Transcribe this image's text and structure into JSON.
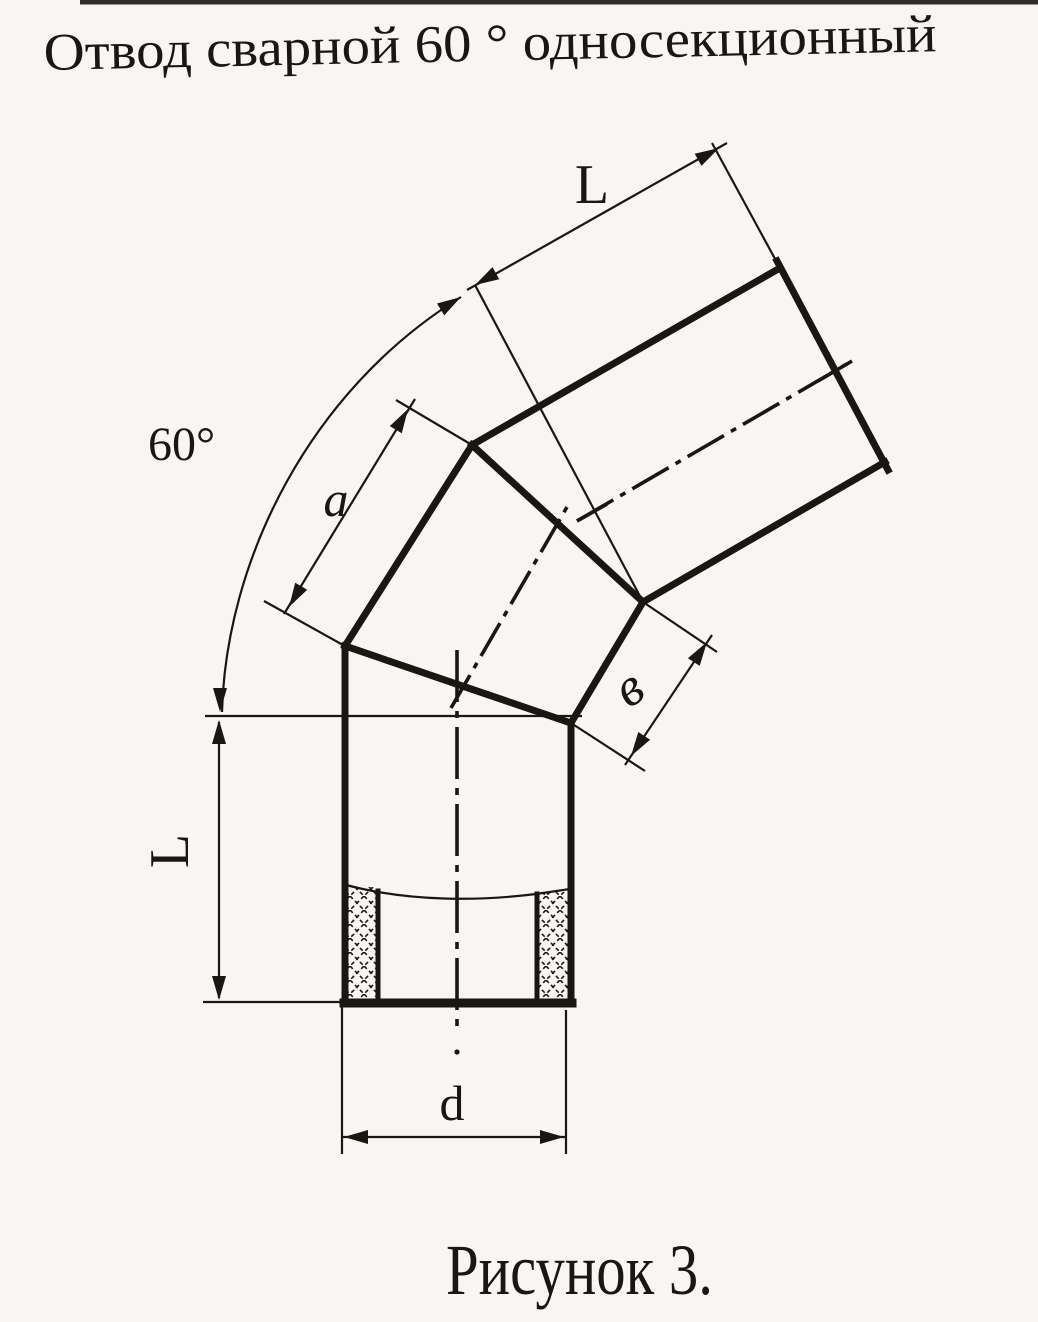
{
  "title": "Отвод сварной 60 ° односекционный",
  "figure_caption": "Рисунок 3.",
  "labels": {
    "segment_length_top": "L",
    "bend_angle": "60°",
    "section_edge_length": "a",
    "section_end_width": "в",
    "segment_length_left": "L",
    "pipe_diameter": "d"
  },
  "colors": {
    "ink": "#1a1713",
    "paper": "#f7f6f2"
  }
}
